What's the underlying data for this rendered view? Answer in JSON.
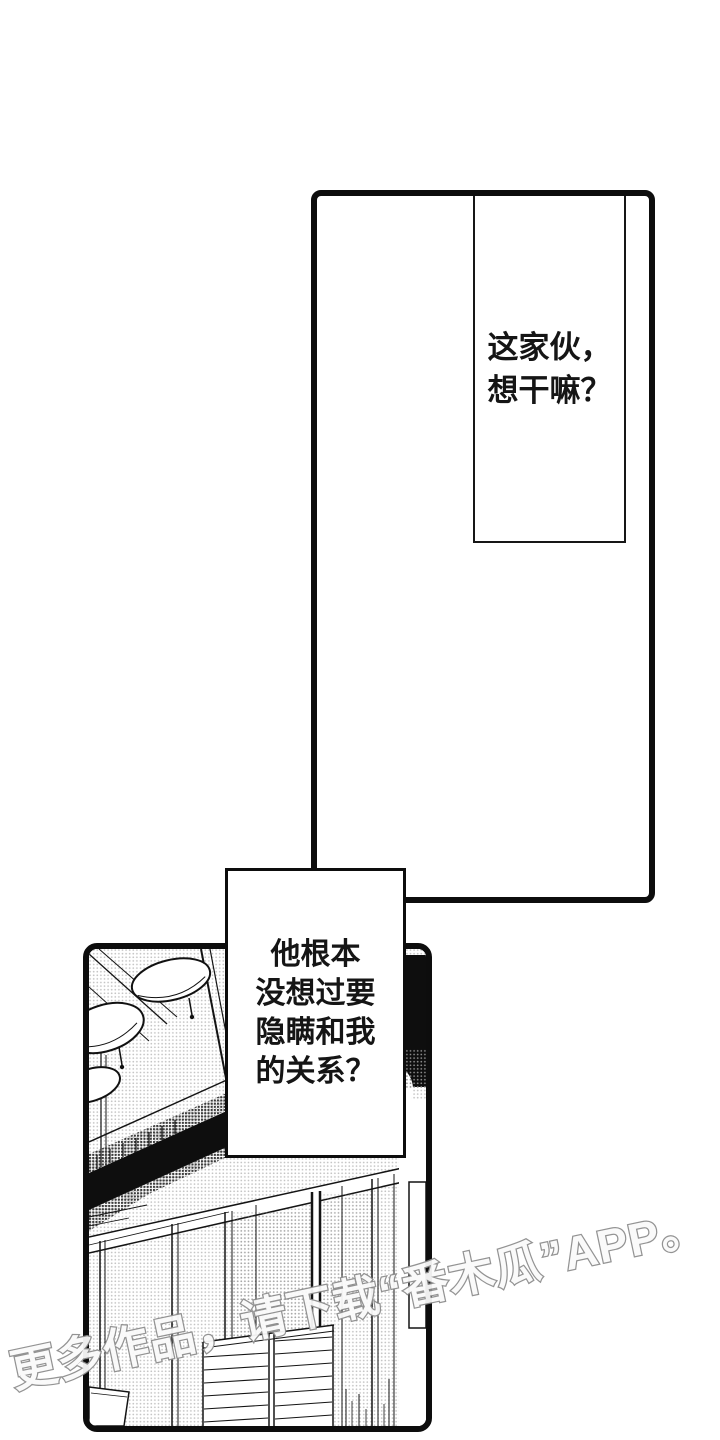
{
  "colors": {
    "ink": "#0d0d0d",
    "paper": "#ffffff",
    "watermark_gray": "#8e8e8e"
  },
  "top_panel": {
    "caption_lines": [
      "这家伙，",
      "想干嘛？"
    ]
  },
  "narration_bubble": {
    "lines": [
      "他根本",
      "没想过要",
      "隐瞒和我",
      "的关系？"
    ]
  },
  "art_panel": {
    "scene_label": "room-interior-ceiling-lights-and-sliding-doors"
  },
  "watermark": {
    "text": "更多作品，请下载“番木瓜”APP。"
  }
}
